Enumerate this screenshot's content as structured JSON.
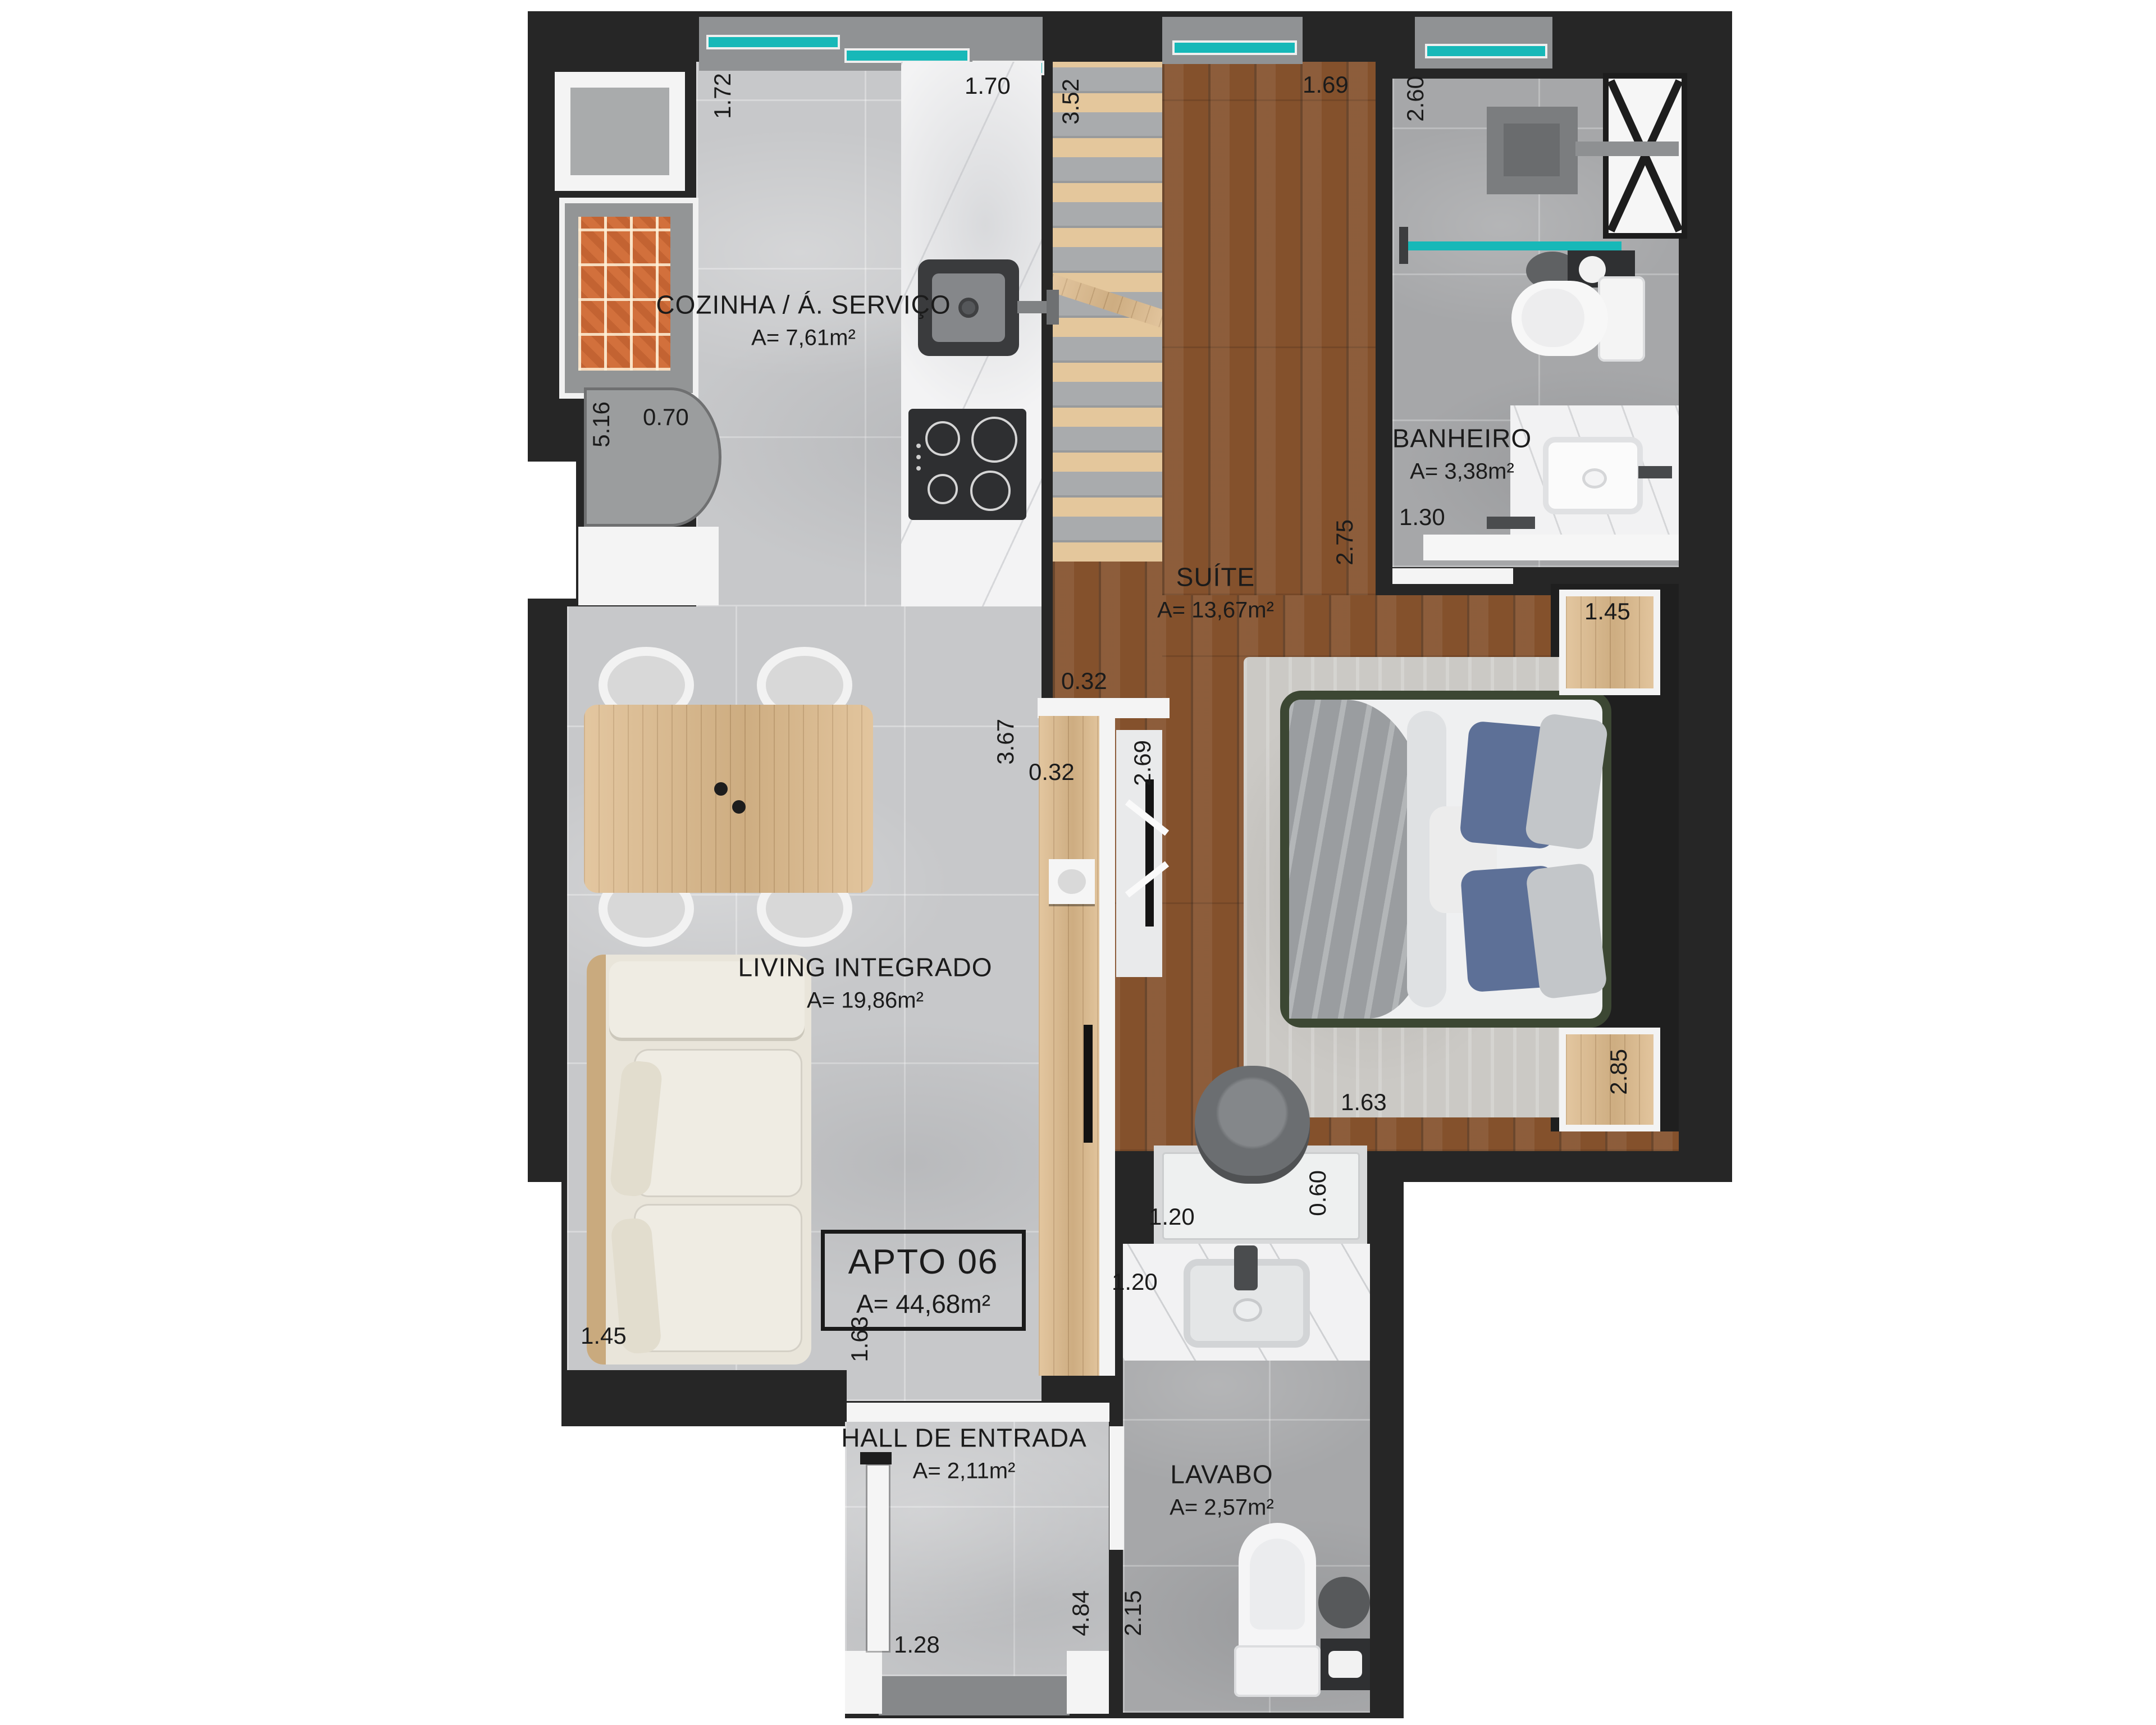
{
  "plan": {
    "apartment": {
      "label": "APTO 06",
      "area": "A= 44,68m²"
    },
    "rooms": [
      {
        "id": "cozinha",
        "label": "COZINHA / Á. SERVIÇO",
        "area": "A= 7,61m²"
      },
      {
        "id": "banheiro",
        "label": "BANHEIRO",
        "area": "A= 3,38m²"
      },
      {
        "id": "suite",
        "label": "SUÍTE",
        "area": "A= 13,67m²"
      },
      {
        "id": "living",
        "label": "LIVING INTEGRADO",
        "area": "A= 19,86m²"
      },
      {
        "id": "hall",
        "label": "HALL DE ENTRADA",
        "area": "A= 2,11m²"
      },
      {
        "id": "lavabo",
        "label": "LAVABO",
        "area": "A= 2,57m²"
      }
    ],
    "dims": {
      "kitchen_left": "1.72",
      "kitchen_right": "1.70",
      "deck_length": "3.52",
      "suite_top_width": "1.69",
      "banheiro_length": "2.60",
      "banheiro_width": "1.30",
      "fridge_run": "5.16",
      "fridge_depth": "0.70",
      "suite_right_length": "2.75",
      "suite_door_wall": "0.32",
      "living_length": "3.67",
      "panel_wall": "0.32",
      "tv_wall": "2.69",
      "nightstand_top": "1.45",
      "suite_width": "2.85",
      "suite_bottom": "1.63",
      "desk_width": "1.20",
      "desk_depth": "0.60",
      "sofa_width": "1.45",
      "living_hall": "1.63",
      "lavabo_counter": "1.20",
      "entry_width": "1.28",
      "hall_length": "4.84",
      "lavabo_length": "2.15"
    },
    "colors": {
      "wall": "#262626",
      "teal": "#17b8b8",
      "marble": "#c7c8ca",
      "tile": "#a6a7a9",
      "wood_dark": "#84512c",
      "wood_light": "#e4c79c",
      "brick": "#d2703c",
      "cream": "#e9e5da",
      "bed_frame": "#3c4733",
      "pillow_blue": "#5d7097",
      "text": "#1b1b1b"
    }
  }
}
